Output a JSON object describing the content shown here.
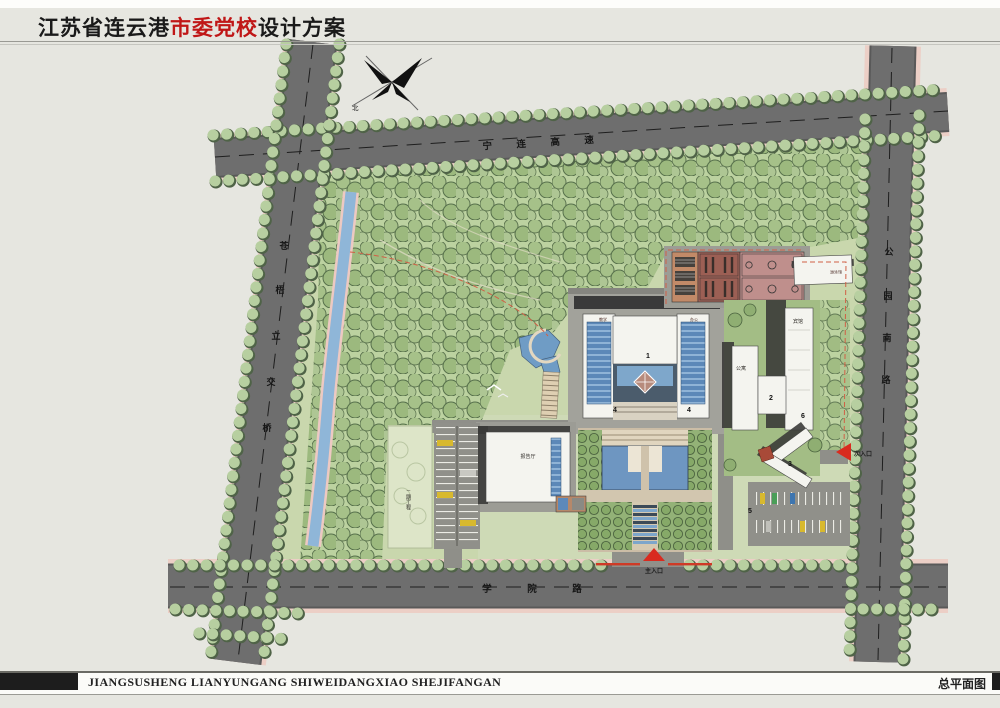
{
  "header": {
    "title_part1": "江苏省连云港",
    "title_accent": "市委党校",
    "title_part2": "设计方案"
  },
  "footer": {
    "romanized_title": "JIANGSUSHENG  LIANYUNGANG  SHIWEIDANGXIAO  SHEJIFANGAN",
    "sheet_label": "总平面图"
  },
  "compass": {
    "north_char": "北"
  },
  "roads": {
    "top": {
      "name": "宁连高速",
      "chars": [
        "宁",
        "连",
        "高",
        "速"
      ]
    },
    "left": {
      "name": "苍梧立交桥",
      "chars": [
        "苍",
        "梧",
        "立",
        "交",
        "桥"
      ]
    },
    "right": {
      "name": "公园南路",
      "chars": [
        "公",
        "园",
        "南",
        "路"
      ]
    },
    "bottom": {
      "name": "学院路",
      "chars": [
        "学",
        "院",
        "路"
      ]
    }
  },
  "entrances": {
    "main_label": "主入口",
    "secondary_label": "次入口"
  },
  "labels": {
    "auditorium": "报告厅",
    "phase2": "二期工程",
    "apartment": "公寓",
    "hotel": "宾馆",
    "natatorium": "游泳馆",
    "teaching": "教学",
    "office": "办公"
  },
  "markers": {
    "n1": "1",
    "n2": "2",
    "n3": "3",
    "n4": "4",
    "n5": "5",
    "n6": "6"
  },
  "colors": {
    "accent_red": "#c01717",
    "road_gray": "#6e6e6e",
    "site_green": "#c9d7ad",
    "forest_green": "#a6c189",
    "water_blue": "#8fb6d8",
    "entrance_red": "#d92b1f",
    "boundary_orange": "#d06046"
  }
}
